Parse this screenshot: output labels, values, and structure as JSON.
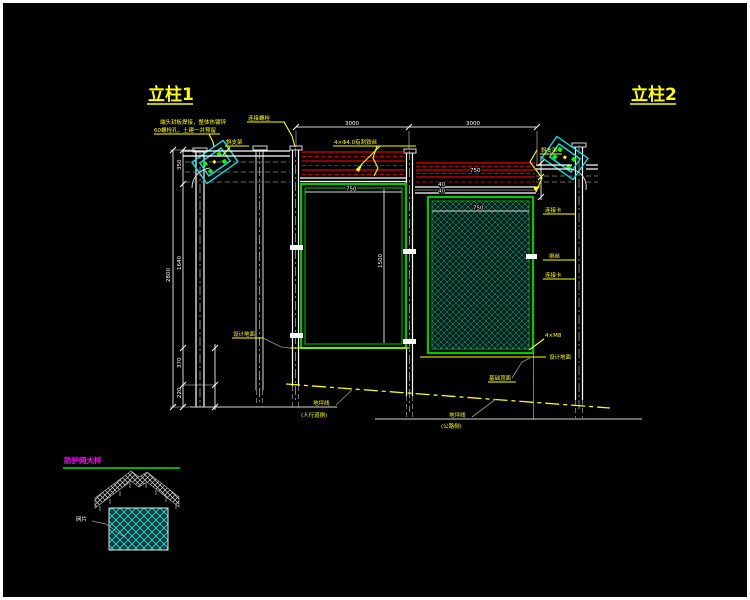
{
  "titles": {
    "left": "立柱1",
    "right": "立柱2",
    "detail": "防护网大样"
  },
  "notes": {
    "install_line1": "端头封板焊接，整体热镀锌",
    "install_line2": "60螺栓孔，土建一并预留",
    "bracket_left": "斜支架",
    "bracket_right": "斜支架",
    "bolt": "连接螺栓",
    "barbed": "4×Φ4.0有刺铁丝",
    "design_ground_left": "设计地面",
    "design_ground_right": "设计地面",
    "foundation_top": "基础顶面",
    "ground_left": "地坪线",
    "ground_left_side": "(人行道侧)",
    "ground_right": "地坪线",
    "ground_right_side": "(公路侧)",
    "mesh": "网片",
    "tie1": "连接卡",
    "tie2": "绑丝",
    "tie3": "连接卡",
    "tie4": "4×M8"
  },
  "dims": {
    "span_left": "3000",
    "span_right": "3000",
    "rail_a": "750",
    "rail_b": "40",
    "rail_c": "40",
    "panel_w_left": "750",
    "panel_h_left": "1500",
    "panel_w_right": "750",
    "chain_1": "350",
    "chain_2": "1640",
    "chain_3": "370",
    "chain_4": "220",
    "chain_total": "2800"
  },
  "colors": {
    "accent_yellow": "#ffff00",
    "wire_red": "#e00000",
    "frame_green": "#00c800",
    "mesh_teal": "#2ed3ae",
    "mesh_cyan": "#00e5e5",
    "detail_magenta": "#ff00ff"
  }
}
